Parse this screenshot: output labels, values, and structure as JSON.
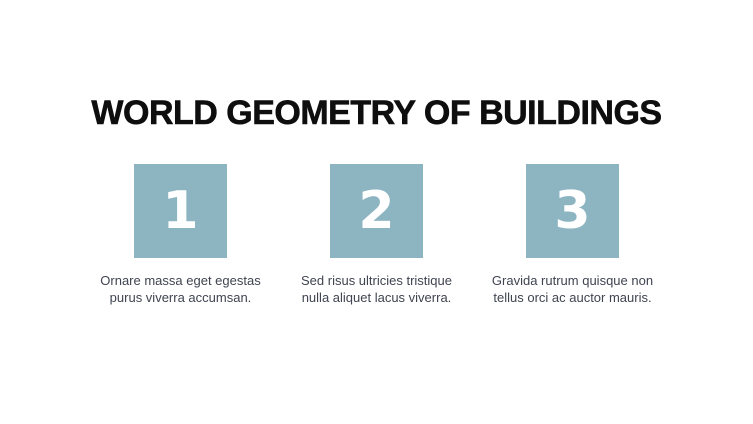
{
  "slide": {
    "title": "WORLD GEOMETRY OF BUILDINGS",
    "background_color": "#ffffff",
    "accent_color": "#8cb5c1",
    "title_color": "#0e0e0e",
    "caption_color": "#3f4450",
    "steps": [
      {
        "number": "1",
        "caption": "Ornare massa eget egestas purus viverra accumsan.",
        "caption_line1": "Ornare massa eget egestas",
        "caption_line2": "purus viverra accumsan."
      },
      {
        "number": "2",
        "caption": "Sed risus ultricies tristique nulla aliquet lacus viverra.",
        "caption_line1": "Sed risus ultricies tristique",
        "caption_line2": "nulla aliquet lacus viverra."
      },
      {
        "number": "3",
        "caption": "Gravida rutrum quisque non tellus orci ac auctor mauris.",
        "caption_line1": "Gravida rutrum quisque non",
        "caption_line2": "tellus orci ac auctor mauris."
      }
    ]
  }
}
